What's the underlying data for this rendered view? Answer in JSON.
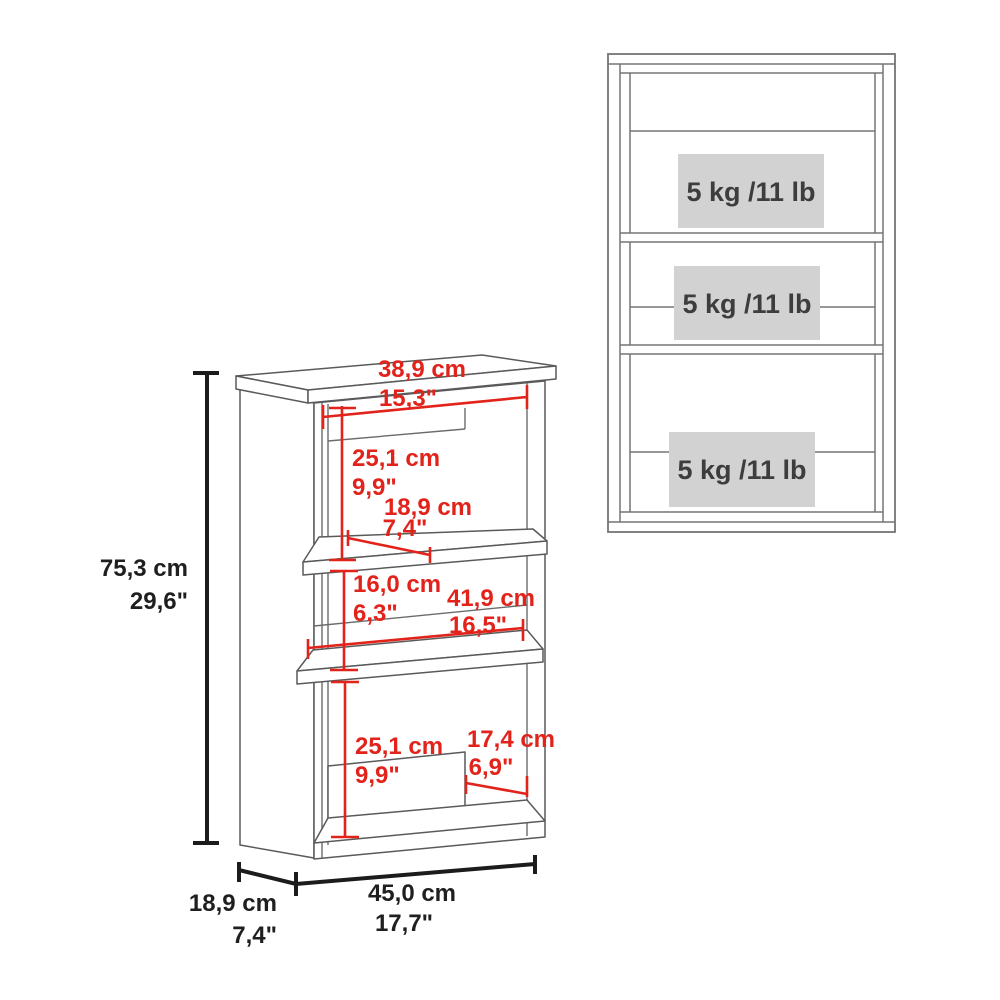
{
  "colors": {
    "dimension_red": "#e2231b",
    "dimension_black": "#1c1c1c",
    "furniture_line_gray": "#6b6b6b",
    "capacity_box_gray": "#d2d2d2",
    "background": "#ffffff"
  },
  "perspective_view": {
    "description": "3-tier wall cabinet perspective view with dimensions",
    "labels": {
      "top_width_cm": "38,9 cm",
      "top_width_in": "15,3\"",
      "upper_section_cm": "25,1 cm",
      "upper_section_in": "9,9\"",
      "shelf_depth_cm": "18,9 cm",
      "shelf_depth_in": "7,4\"",
      "middle_section_cm": "16,0 cm",
      "middle_section_in": "6,3\"",
      "inner_width_cm": "41,9 cm",
      "inner_width_in": "16,5\"",
      "lower_section_cm": "25,1 cm",
      "lower_section_in": "9,9\"",
      "lower_inner_cm": "17,4 cm",
      "lower_inner_in": "6,9\"",
      "overall_height_cm": "75,3 cm",
      "overall_height_in": "29,6\"",
      "overall_depth_cm": "18,9 cm",
      "overall_depth_in": "7,4\"",
      "overall_width_cm": "45,0 cm",
      "overall_width_in": "17,7\""
    }
  },
  "front_view": {
    "description": "Front view with shelf load capacities",
    "shelves": [
      {
        "capacity": "5 kg /11 lb"
      },
      {
        "capacity": "5 kg /11 lb"
      },
      {
        "capacity": "5 kg /11 lb"
      }
    ]
  }
}
